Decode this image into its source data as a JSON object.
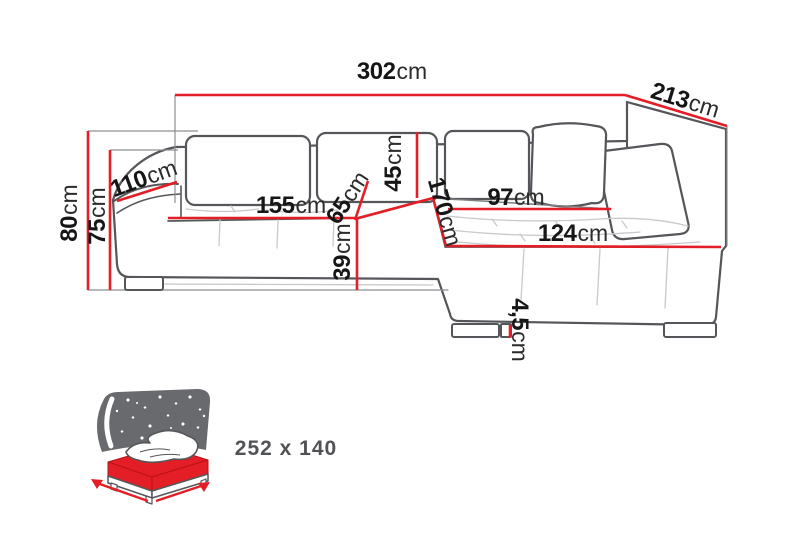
{
  "diagram": {
    "product": "corner-sofa-dimension-diagram",
    "dimensions": [
      {
        "id": "overall-width",
        "value": "302",
        "unit": "cm"
      },
      {
        "id": "overall-depth",
        "value": "213",
        "unit": "cm"
      },
      {
        "id": "total-height",
        "value": "80",
        "unit": "cm"
      },
      {
        "id": "backrest-height",
        "value": "75",
        "unit": "cm"
      },
      {
        "id": "side-depth",
        "value": "110",
        "unit": "cm"
      },
      {
        "id": "seat-width",
        "value": "155",
        "unit": "cm"
      },
      {
        "id": "seat-depth",
        "value": "65",
        "unit": "cm"
      },
      {
        "id": "back-cushion-height",
        "value": "45",
        "unit": "cm"
      },
      {
        "id": "seat-height",
        "value": "39",
        "unit": "cm"
      },
      {
        "id": "chaise-length",
        "value": "170",
        "unit": "cm"
      },
      {
        "id": "chaise-seat-width",
        "value": "97",
        "unit": "cm"
      },
      {
        "id": "chaise-width",
        "value": "124",
        "unit": "cm"
      },
      {
        "id": "leg-height",
        "value": "4,5",
        "unit": "cm"
      }
    ],
    "sleeping_area": {
      "value": "252 x 140"
    },
    "colors": {
      "dimension_line": "#e41e26",
      "outline": "#55565a",
      "seam": "#c8c9cb",
      "leader": "#8e8f92",
      "icon_background": "#696a6e",
      "label_text": "#161616",
      "sleeping_text": "#515256"
    }
  }
}
